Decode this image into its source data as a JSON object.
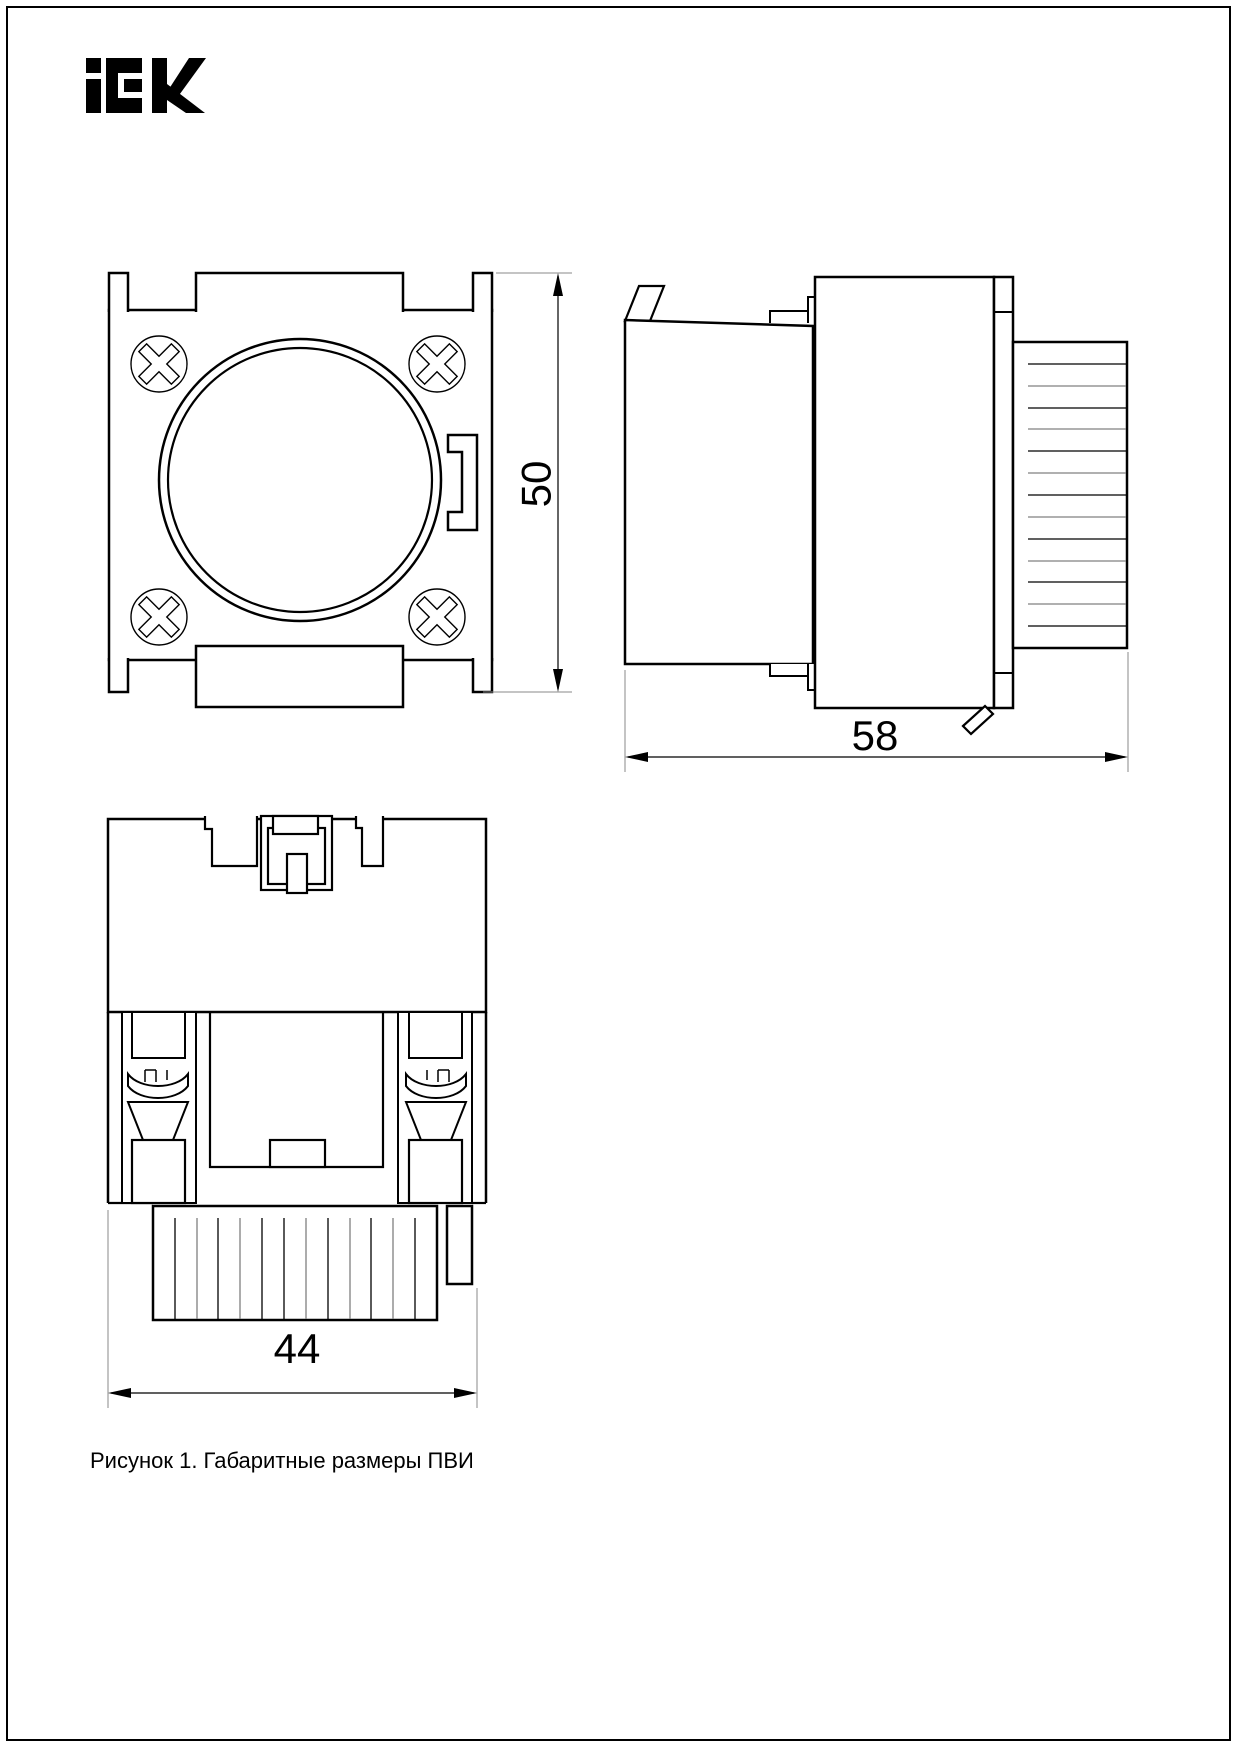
{
  "page": {
    "background": "#ffffff",
    "border_color": "#000000",
    "line_color": "#000000",
    "extension_line_color": "#888888",
    "rib_line_alt_color": "#808080"
  },
  "brand": {
    "logo_text": "iEK"
  },
  "figure": {
    "caption": "Рисунок 1. Габаритные размеры ПВИ",
    "dimensions": {
      "height_mm": {
        "label": "50"
      },
      "depth_mm": {
        "label": "58"
      },
      "width_mm": {
        "label": "44"
      }
    }
  }
}
